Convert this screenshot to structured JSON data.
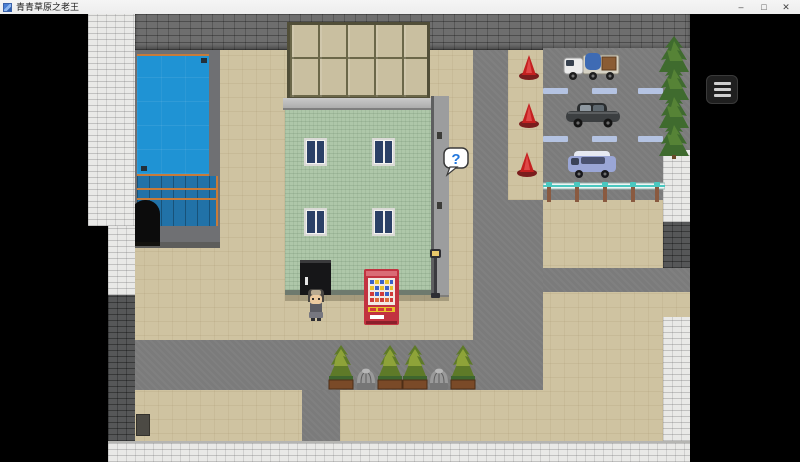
{
  "window": {
    "title": "青青草原之老王",
    "icon": "game-app-icon",
    "controls": {
      "minimize": "–",
      "maximize": "□",
      "close": "✕"
    }
  },
  "menu": {
    "button_icon": "hamburger-menu-icon"
  },
  "game": {
    "question_balloon": "?",
    "scene": {
      "description": "RPG Maker style town map: swimming pool, green tiled building with greenhouse glass roof, red vending machine, old-man player sprite, parking lot with three vehicles, traffic cones, cypress trees, planter trees and stone wells along a road",
      "counts": {
        "vehicles": 3,
        "traffic_cones": 3,
        "parking_space_markers": 6,
        "cypress_trees_right": 4,
        "planter_trees": 4,
        "stone_wells": 2,
        "building_windows": 4
      },
      "vehicles": [
        "white truck with blue tarp cargo",
        "dark gray sedan",
        "light blue van"
      ],
      "objects": [
        "swimming pool",
        "arched doorway",
        "greenhouse glass roof",
        "red vending machine",
        "street lamp",
        "question balloon",
        "guard rail",
        "stone boundary walls"
      ]
    },
    "colors": {
      "ground": "#cfc3a1",
      "road": "#7b7b7b",
      "water": "#1f93d4",
      "building_wall": "#aec7a9",
      "glass_roof": "#c9bfa0",
      "vending_machine": "#c23240",
      "balloon_question": "#2277dd",
      "white_wall": "#e9e9e7",
      "brick_wall": "#6e6e6e"
    }
  }
}
